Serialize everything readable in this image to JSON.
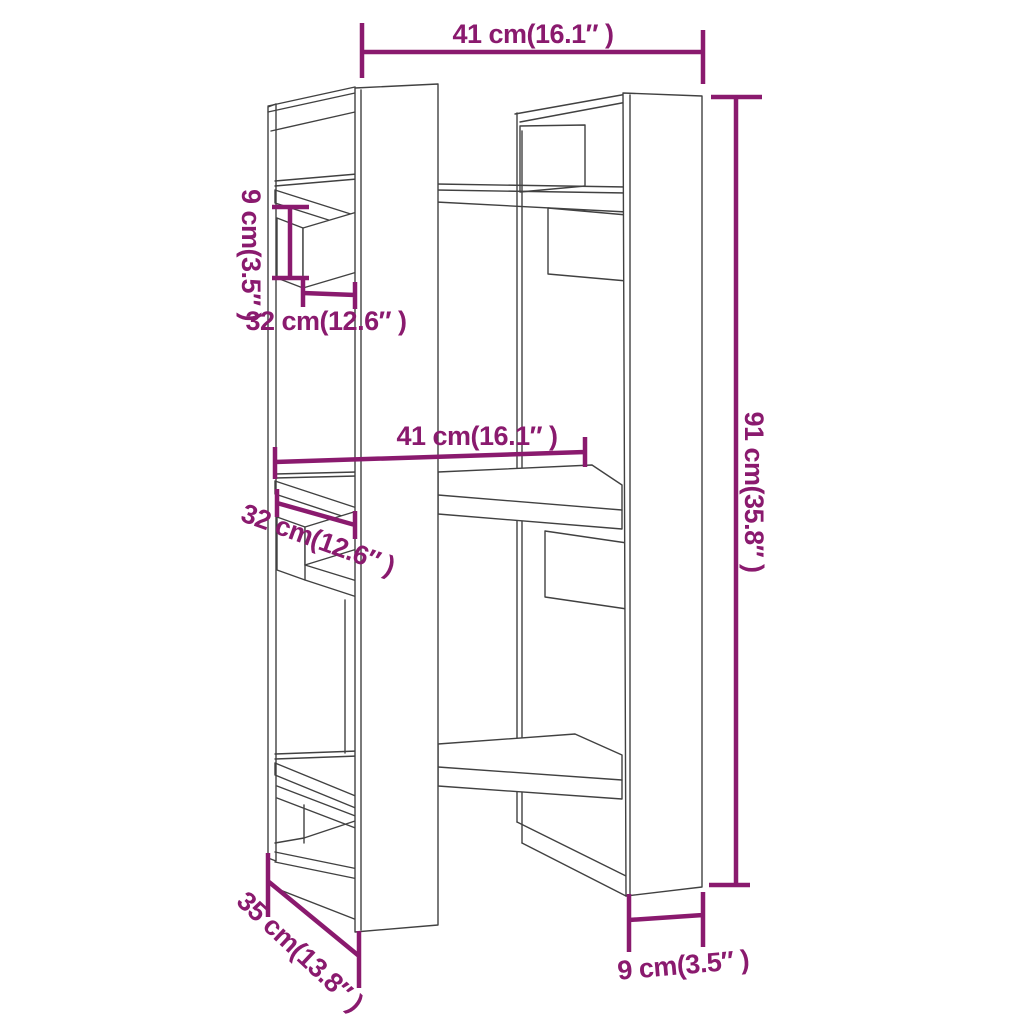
{
  "page": {
    "background": "#ffffff"
  },
  "diagram": {
    "type": "furniture-dimension-drawing",
    "subject": "book-cabinet-room-divider",
    "line_color": "#414141",
    "accent_color": "#8a1a6e",
    "dimensions": {
      "top_width": "41 cm(16.1″ )",
      "upper_rail_height": "9 cm(3.5″ )",
      "upper_rail_width": "32 cm(12.6″ )",
      "middle_shelf_width": "41 cm(16.1″ )",
      "middle_rail_width": "32 cm(12.6″ )",
      "overall_height": "91 cm(35.8″ )",
      "depth": "35 cm(13.8″ )",
      "bottom_right_height": "9 cm(3.5″ )"
    }
  }
}
